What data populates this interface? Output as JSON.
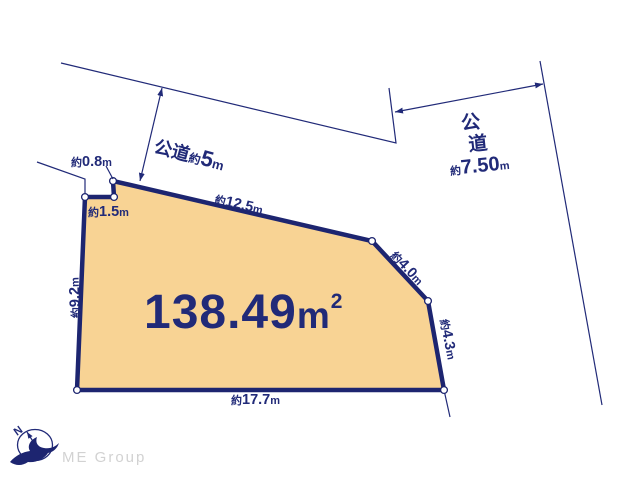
{
  "area": {
    "value": "138.49",
    "unit": "m",
    "sup": "2"
  },
  "dims": {
    "d08": {
      "p": "約",
      "v": "0.8",
      "u": "m"
    },
    "d15": {
      "p": "約",
      "v": "1.5",
      "u": "m"
    },
    "d92": {
      "p": "約",
      "v": "9.2",
      "u": "m"
    },
    "d177": {
      "p": "約",
      "v": "17.7",
      "u": "m"
    },
    "d125": {
      "p": "約",
      "v": "12.5",
      "u": "m"
    },
    "d40": {
      "p": "約",
      "v": "4.0",
      "u": "m"
    },
    "d43": {
      "p": "約",
      "v": "4.3",
      "u": "m"
    }
  },
  "roads": {
    "top": {
      "name": "公道",
      "p": "約",
      "v": "5",
      "u": "m"
    },
    "right": {
      "name_char1": "公",
      "name_char2": "道",
      "p": "約",
      "v": "7.50",
      "u": "m"
    }
  },
  "compass": {
    "north_label": "N"
  },
  "watermark": {
    "text": "ME Group"
  },
  "colors": {
    "line": "#212a78",
    "parcel_fill": "#f8d394",
    "watermark": "#d2d2d2"
  }
}
